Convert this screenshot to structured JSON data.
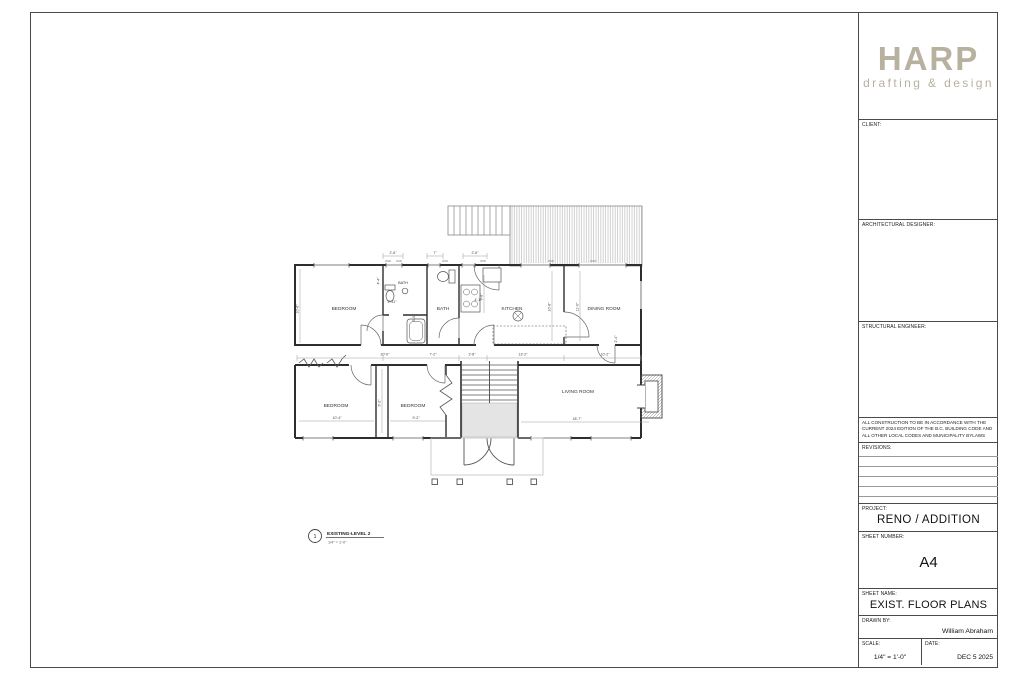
{
  "colors": {
    "logo": "#b8b1a0",
    "wall": "#2e2e2e",
    "line": "#4a4a4a",
    "landing_fill": "#e4e4e4"
  },
  "title_block": {
    "logo": {
      "name": "HARP",
      "tagline": "drafting & design"
    },
    "client_label": "CLIENT:",
    "architectural_designer_label": "ARCHITECTURAL DESIGNER:",
    "structural_engineer_label": "STRUCTURAL ENGINEER:",
    "code_note": "ALL CONSTRUCTION TO BE IN ACCORDANCE WITH THE CURRENT 2024 EDITION OF THE B.C. BUILDING CODE AND ALL OTHER LOCAL CODES AND MUNICIPALITY BYLAWS",
    "revisions_label": "REVISIONS:",
    "project_label": "PROJECT:",
    "project_value": "RENO / ADDITION",
    "sheet_number_label": "SHEET NUMBER:",
    "sheet_number_value": "A4",
    "sheet_name_label": "SHEET NAME:",
    "sheet_name_value": "EXIST. FLOOR PLANS",
    "drawn_by_label": "DRAWN BY:",
    "drawn_by_value": "William Abraham",
    "scale_label": "SCALE:",
    "scale_value": "1/4\" = 1'-0\"",
    "date_label": "DATE:",
    "date_value": "DEC 5 2025"
  },
  "plan": {
    "callout": {
      "number": "1",
      "title": "EXISTING-LEVEL 2",
      "scale": "1/4\" = 1'-0\""
    },
    "rooms": [
      "BEDROOM",
      "BATH",
      "BATH",
      "KITCHEN",
      "DINING ROOM",
      "BEDROOM",
      "BEDROOM",
      "LIVING ROOM"
    ],
    "dims": [
      "2'-6\"",
      "7\"",
      "2'-6\"",
      "20'-0\"",
      "7'-2\"",
      "2'-8\"",
      "13'-2\"",
      "10'-2\"",
      "10'-4\"",
      "9'-2\"",
      "18'-7\"",
      "10'-8\"",
      "4'-4\"",
      "9'-8\"",
      "10'-8\"",
      "11'-0\"",
      "9'-2\"",
      "2'-11\"",
      "4'-1\"",
      "3'-0\"",
      "2'-4\""
    ],
    "window_tags": [
      "2030",
      "2030",
      "2030",
      "3030",
      "3030",
      "4030"
    ]
  }
}
